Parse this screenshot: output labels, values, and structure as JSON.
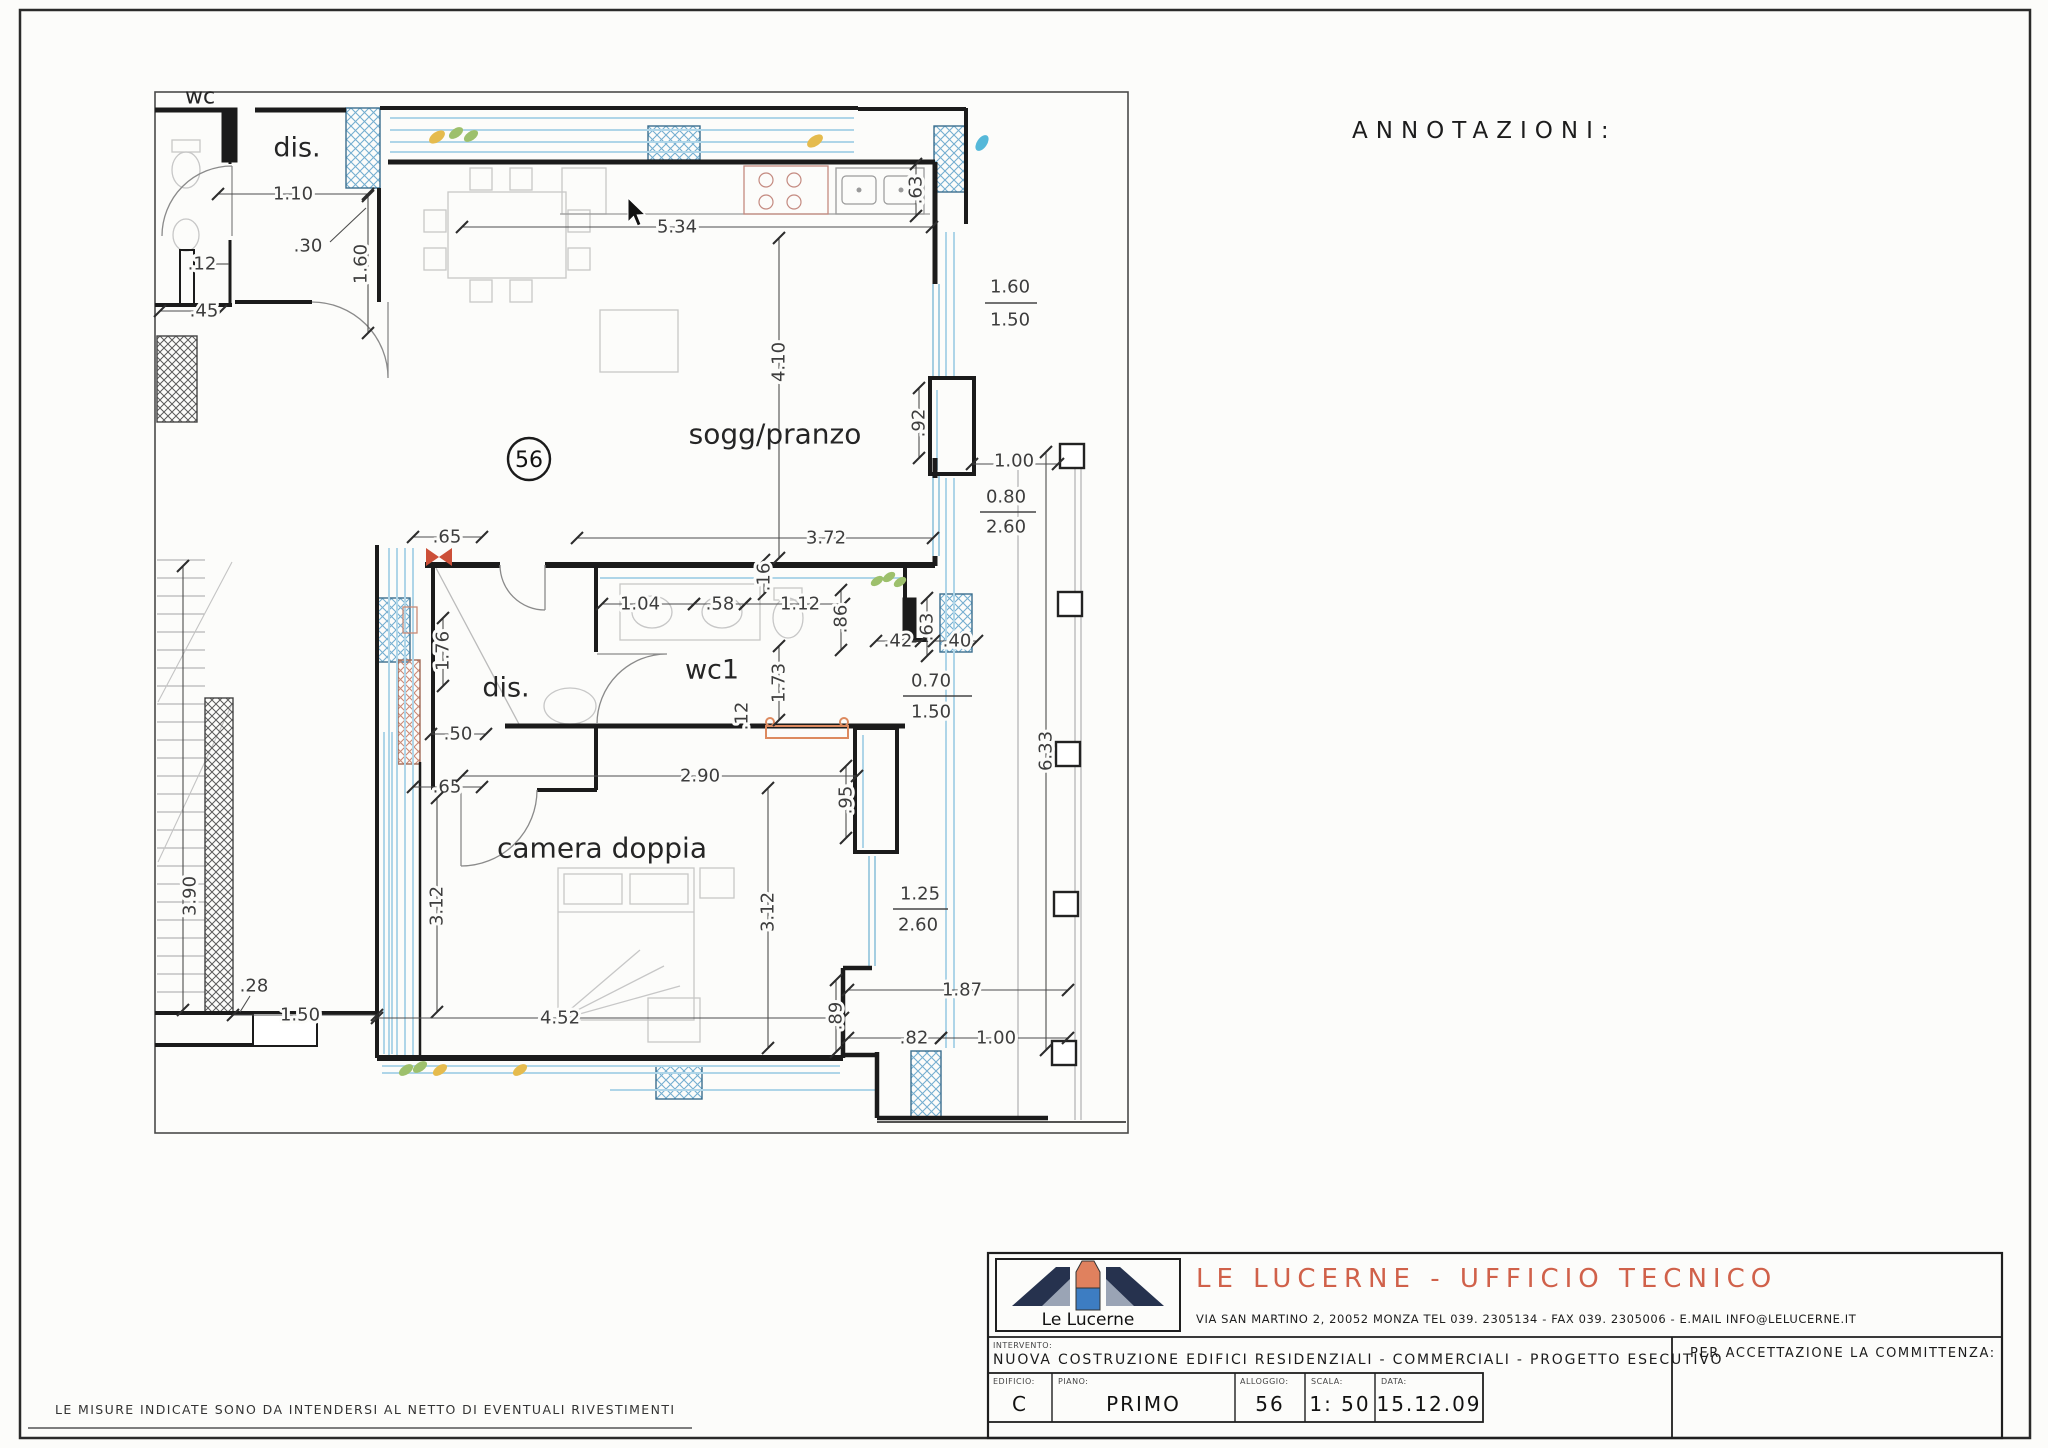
{
  "annotations_heading": "ANNOTAZIONI:",
  "footer_note": "LE MISURE INDICATE SONO DA INTENDERSI AL NETTO DI EVENTUALI RIVESTIMENTI",
  "plan": {
    "unit_badge": "56",
    "rooms": [
      {
        "t": "wc",
        "x": 200,
        "y": 97,
        "s": 22
      },
      {
        "t": "dis.",
        "x": 297,
        "y": 148,
        "s": 27
      },
      {
        "t": "sogg/pranzo",
        "x": 775,
        "y": 434,
        "s": 28
      },
      {
        "t": "wc1",
        "x": 712,
        "y": 670,
        "s": 27
      },
      {
        "t": "dis.",
        "x": 506,
        "y": 688,
        "s": 27
      },
      {
        "t": "camera doppia",
        "x": 602,
        "y": 848,
        "s": 28
      }
    ],
    "dimensions": [
      {
        "t": "1.10",
        "x": 293,
        "y": 194,
        "l": [
          218,
          194,
          368,
          194
        ]
      },
      {
        "t": ".30",
        "x": 308,
        "y": 246,
        "ld": [
          330,
          242,
          366,
          208
        ]
      },
      {
        "t": "1.60",
        "x": 361,
        "y": 264,
        "r": -90,
        "l": [
          368,
          196,
          368,
          333
        ]
      },
      {
        "t": ".12",
        "x": 202,
        "y": 264,
        "ld": [
          216,
          264,
          229,
          264
        ]
      },
      {
        "t": ".45",
        "x": 204,
        "y": 311,
        "l": [
          160,
          311,
          221,
          311
        ]
      },
      {
        "t": "5.34",
        "x": 677,
        "y": 227,
        "l": [
          462,
          227,
          932,
          227
        ]
      },
      {
        "t": ".63",
        "x": 916,
        "y": 190,
        "r": -90,
        "l": [
          916,
          164,
          916,
          216
        ]
      },
      {
        "t": "4.10",
        "x": 779,
        "y": 362,
        "r": -90,
        "l": [
          779,
          238,
          779,
          558
        ]
      },
      {
        "t": "1.60",
        "x": 1010,
        "y": 287
      },
      {
        "t": "1.50",
        "x": 1010,
        "y": 320
      },
      {
        "t": ".92",
        "x": 919,
        "y": 423,
        "r": -90,
        "l": [
          919,
          388,
          919,
          458
        ]
      },
      {
        "t": "1.00",
        "x": 1014,
        "y": 461,
        "l": [
          972,
          464,
          1058,
          464
        ]
      },
      {
        "t": "0.80",
        "x": 1006,
        "y": 497
      },
      {
        "t": "2.60",
        "x": 1006,
        "y": 527
      },
      {
        "t": "3.72",
        "x": 826,
        "y": 538,
        "l": [
          577,
          538,
          933,
          538
        ]
      },
      {
        "t": ".65",
        "x": 447,
        "y": 537,
        "l": [
          413,
          537,
          482,
          537
        ]
      },
      {
        "t": "1.04",
        "x": 640,
        "y": 604,
        "l": [
          602,
          604,
          694,
          604
        ]
      },
      {
        "t": ".58",
        "x": 720,
        "y": 604,
        "l": [
          694,
          604,
          745,
          604
        ]
      },
      {
        "t": "1.12",
        "x": 800,
        "y": 604,
        "l": [
          745,
          604,
          844,
          604
        ]
      },
      {
        "t": ".16",
        "x": 764,
        "y": 577,
        "r": -90,
        "l": [
          764,
          560,
          764,
          594
        ]
      },
      {
        "t": ".86",
        "x": 841,
        "y": 619,
        "r": -90,
        "l": [
          841,
          590,
          841,
          650
        ]
      },
      {
        "t": ".42",
        "x": 898,
        "y": 641,
        "l": [
          876,
          641,
          921,
          641
        ]
      },
      {
        "t": ".63",
        "x": 927,
        "y": 627,
        "r": -90,
        "l": [
          927,
          598,
          927,
          656
        ]
      },
      {
        "t": ".40",
        "x": 957,
        "y": 641,
        "l": [
          934,
          641,
          977,
          641
        ]
      },
      {
        "t": "0.70",
        "x": 931,
        "y": 681
      },
      {
        "t": "1.50",
        "x": 931,
        "y": 712
      },
      {
        "t": "1.73",
        "x": 779,
        "y": 683,
        "r": -90,
        "l": [
          779,
          646,
          779,
          720
        ]
      },
      {
        "t": ".12",
        "x": 742,
        "y": 716,
        "r": -90
      },
      {
        "t": "1.76",
        "x": 443,
        "y": 651,
        "r": -90,
        "l": [
          443,
          618,
          443,
          686
        ]
      },
      {
        "t": ".50",
        "x": 458,
        "y": 734,
        "l": [
          431,
          734,
          486,
          734
        ]
      },
      {
        "t": ".65",
        "x": 447,
        "y": 787,
        "l": [
          413,
          787,
          482,
          787
        ]
      },
      {
        "t": "2.90",
        "x": 700,
        "y": 776,
        "l": [
          462,
          776,
          857,
          776
        ]
      },
      {
        "t": ".95",
        "x": 846,
        "y": 800,
        "r": -90,
        "l": [
          846,
          766,
          846,
          838
        ]
      },
      {
        "t": "1.25",
        "x": 920,
        "y": 894
      },
      {
        "t": "2.60",
        "x": 918,
        "y": 925
      },
      {
        "t": "3.12",
        "x": 437,
        "y": 906,
        "r": -90,
        "l": [
          437,
          798,
          437,
          1012
        ]
      },
      {
        "t": "3.12",
        "x": 768,
        "y": 912,
        "r": -90,
        "l": [
          768,
          788,
          768,
          1048
        ]
      },
      {
        "t": "6.33",
        "x": 1046,
        "y": 751,
        "r": -90,
        "l": [
          1046,
          452,
          1046,
          1050
        ]
      },
      {
        "t": "3.90",
        "x": 190,
        "y": 896,
        "r": -90,
        "l": [
          183,
          566,
          183,
          1010
        ]
      },
      {
        "t": ".28",
        "x": 254,
        "y": 986,
        "ld": [
          250,
          996,
          240,
          1012
        ]
      },
      {
        "t": "1.50",
        "x": 300,
        "y": 1015,
        "l": [
          233,
          1015,
          377,
          1015
        ]
      },
      {
        "t": "4.52",
        "x": 560,
        "y": 1018,
        "l": [
          377,
          1018,
          843,
          1018
        ]
      },
      {
        "t": ".89",
        "x": 836,
        "y": 1016,
        "r": -90,
        "l": [
          836,
          980,
          836,
          1052
        ]
      },
      {
        "t": "1.87",
        "x": 962,
        "y": 990,
        "l": [
          848,
          990,
          1068,
          990
        ]
      },
      {
        "t": ".82",
        "x": 914,
        "y": 1038,
        "l": [
          848,
          1038,
          941,
          1038
        ]
      },
      {
        "t": "1.00",
        "x": 996,
        "y": 1038,
        "l": [
          941,
          1038,
          1068,
          1038
        ]
      }
    ]
  },
  "title_block": {
    "logo_caption": "Le Lucerne",
    "company": "LE LUCERNE - UFFICIO TECNICO",
    "address": "VIA SAN MARTINO  2, 20052 MONZA  TEL 039. 2305134 - FAX 039. 2305006 - E.MAIL INFO@LELUCERNE.IT",
    "intervento_label": "INTERVENTO:",
    "intervento": "NUOVA COSTRUZIONE EDIFICI RESIDENZIALI - COMMERCIALI - PROGETTO ESECUTIVO",
    "acceptance": "PER ACCETTAZIONE LA COMMITTENZA:",
    "fields": [
      {
        "label": "EDIFICIO:",
        "value": "C"
      },
      {
        "label": "PIANO:",
        "value": "PRIMO"
      },
      {
        "label": "ALLOGGIO:",
        "value": "56"
      },
      {
        "label": "SCALA:",
        "value": "1: 50"
      },
      {
        "label": "DATA:",
        "value": "15.12.09"
      }
    ]
  },
  "colors": {
    "accent": "#d0614a",
    "wall": "#1b1b1b",
    "lining_blue": "#aed5e8",
    "hatch_blue": "#74aed0",
    "hatch_red": "#c98a77",
    "hatch_dark": "#5a5a5a",
    "leaf_green": "#9dc06c",
    "leaf_yellow": "#e5bb4d",
    "leaf_blue": "#55b8d9",
    "radiator": "#dd8a5f"
  }
}
